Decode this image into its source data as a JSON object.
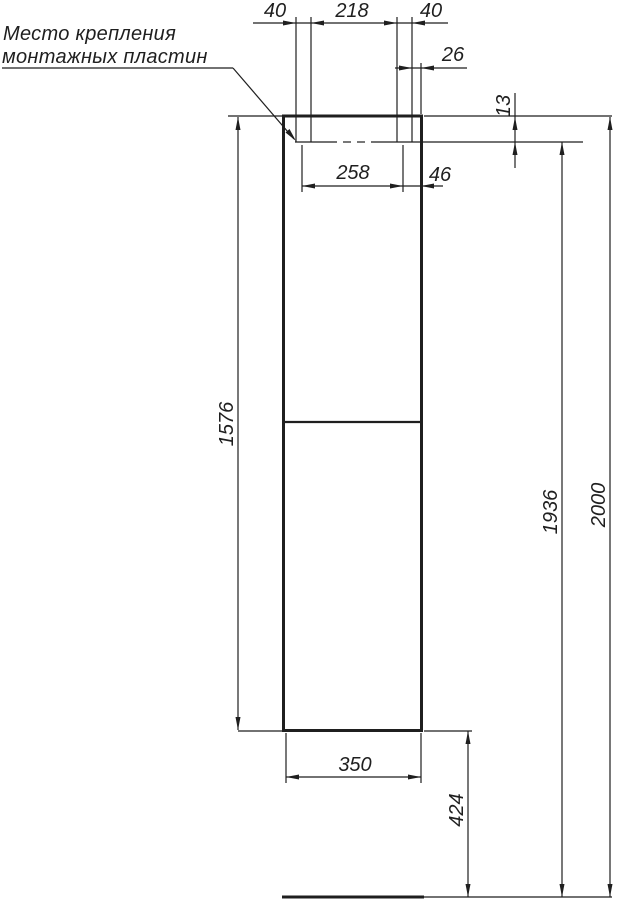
{
  "callout": {
    "line1": "Место крепления",
    "line2": "монтажных пластин"
  },
  "dims": {
    "top_left_40": "40",
    "top_218": "218",
    "top_right_40": "40",
    "edge_26": "26",
    "depth_13": "13",
    "centers_258": "258",
    "center_edge_46": "46",
    "height_1576": "1576",
    "mount_1936": "1936",
    "total_2000": "2000",
    "width_350": "350",
    "floor_424": "424"
  },
  "colors": {
    "line": "#1f1f1f",
    "background": "#ffffff"
  }
}
